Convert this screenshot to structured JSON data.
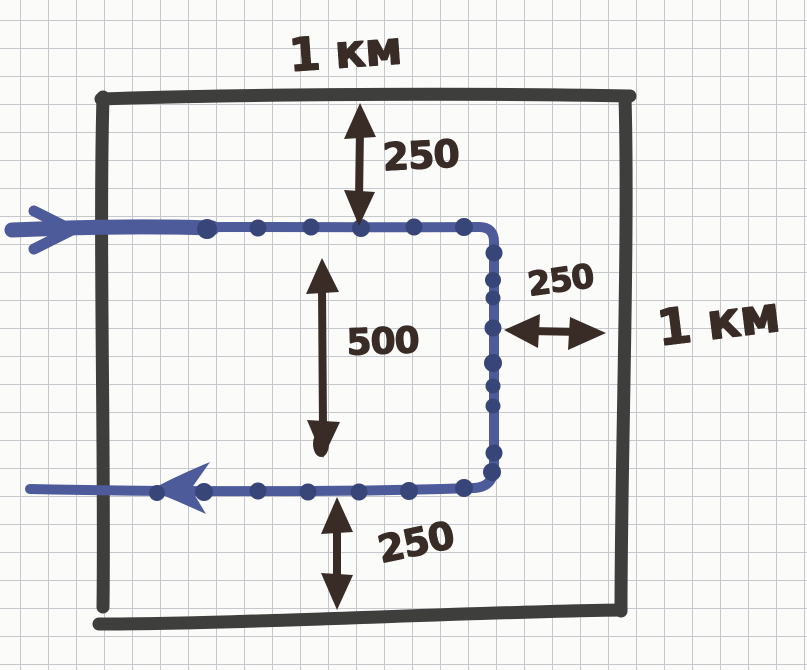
{
  "square": {
    "width": "1 км",
    "height": "1 км"
  },
  "dimensions": [
    {
      "name": "top-offset",
      "value": "250"
    },
    {
      "name": "inner-height",
      "value": "500"
    },
    {
      "name": "right-offset",
      "value": "250"
    },
    {
      "name": "bottom-offset",
      "value": "250"
    }
  ],
  "colors": {
    "paper": "#fbfbfa",
    "grid": "#c7c8cd",
    "square_ink": "#3e3e3c",
    "annotation": "#392c27",
    "route": "#4e5b9b",
    "route_dots": "#374578"
  }
}
